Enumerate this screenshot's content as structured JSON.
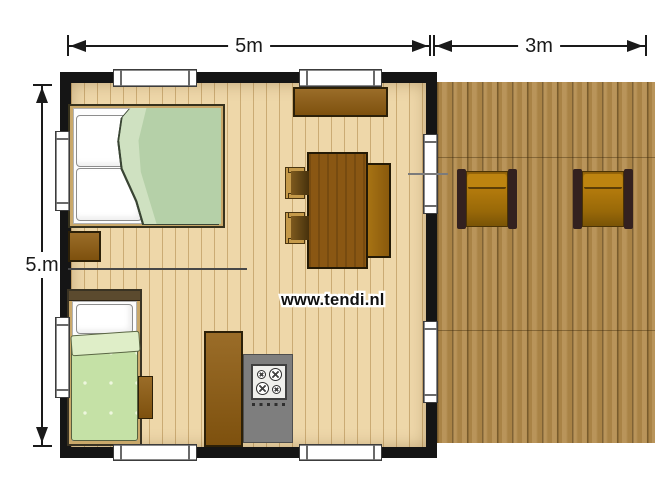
{
  "dimensions": {
    "house_width": "5m",
    "deck_width": "3m",
    "house_depth": "5.m"
  },
  "watermark": {
    "text": "www.tendi.nl"
  },
  "rooms": {
    "bedroom_large": "double bed with bedside cabinet",
    "bedroom_small": "single bed with side cabinet",
    "living": "dining table, bench, two chairs, sideboard",
    "kitchen": "tall cabinet, counter with 4-burner stove",
    "terrace": "wooden deck with two lounge chairs"
  },
  "colors": {
    "wall": "#151515",
    "floor": "#eed7a9",
    "deck": "#b28a4a",
    "furniture_brown": "#8f5c10",
    "double_bed_blanket": "#b5d0a8",
    "single_bed_blanket": "#c5e1a6",
    "counter_gray": "#7e7e7e",
    "deck_chair_frame": "#33211f",
    "deck_chair_seat": "#b1790c",
    "dimension_line": "#1a1a1a"
  }
}
